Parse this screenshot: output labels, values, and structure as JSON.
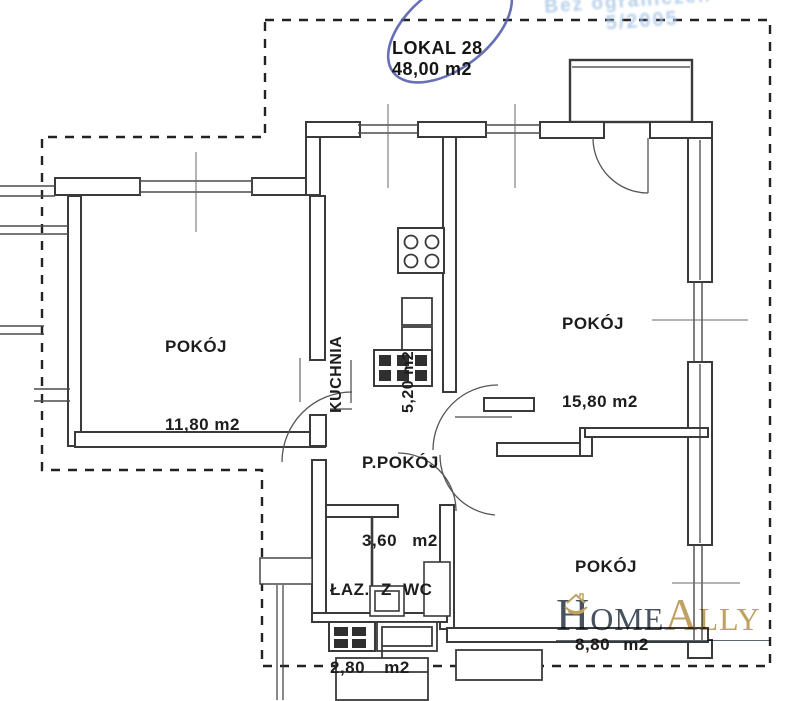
{
  "title": {
    "line1": "LOKAL 28",
    "line2": "48,00 m2"
  },
  "stamp": {
    "line1": "Bez ograniczeń",
    "line2": "5/2005"
  },
  "rooms": [
    {
      "name": "POKÓJ",
      "area": "11,80 m2"
    },
    {
      "name": "KUCHNIA",
      "area": "5,20 m2"
    },
    {
      "name": "POKÓJ",
      "area": "15,80 m2"
    },
    {
      "name": "P.POKÓJ",
      "area": "3,60 m2"
    },
    {
      "name": "ŁAZ. Z WC",
      "area": "2,80 m2"
    },
    {
      "name": "POKÓJ",
      "area": "8,80 m2"
    }
  ],
  "logo": {
    "part1": "Home",
    "part2": "Ally"
  },
  "colors": {
    "line": "#3a3a3a",
    "pen_blue": "#5661ac",
    "stamp_blue": "#a9c7e6",
    "logo_dark": "#47525e",
    "logo_gold": "#bfa161"
  },
  "icons": [
    "pen-circle-annotation",
    "homeally-house-in-hands-icon"
  ]
}
